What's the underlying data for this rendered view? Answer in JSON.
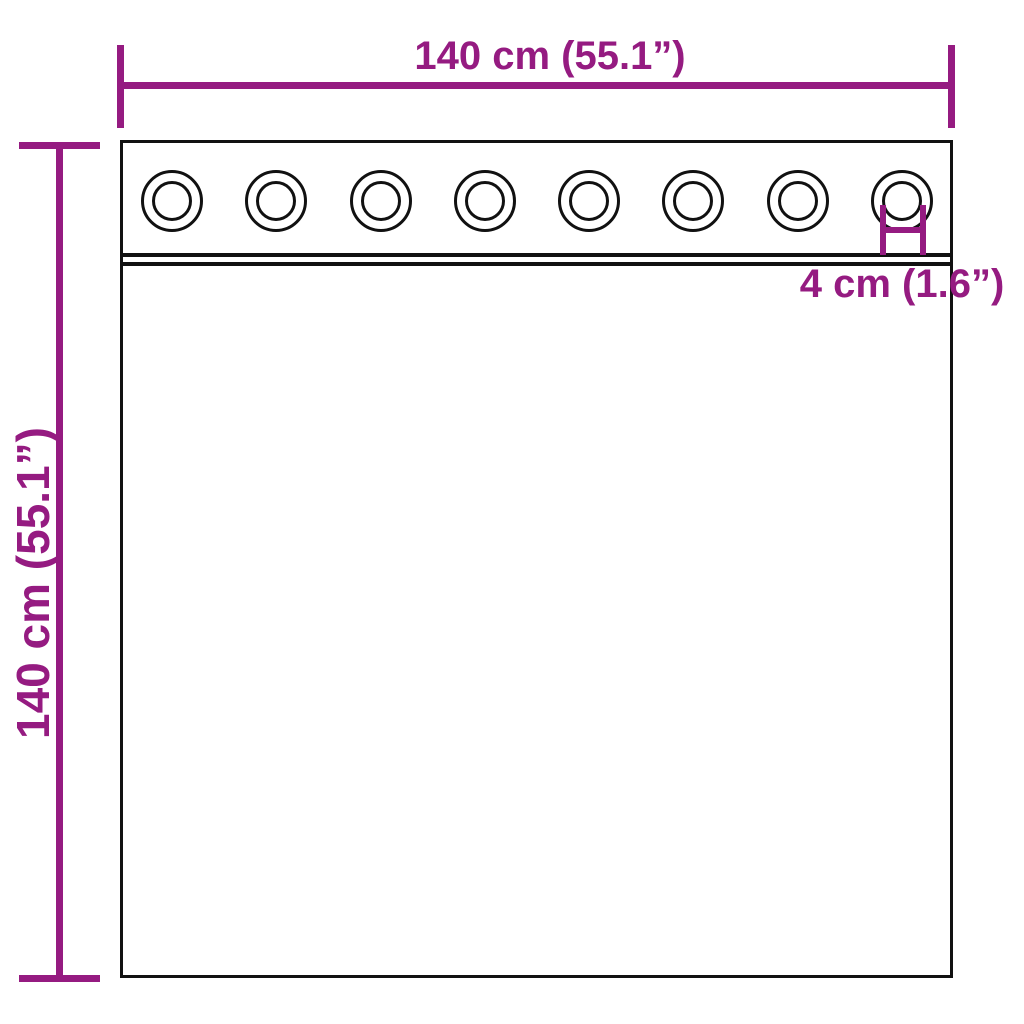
{
  "diagram": {
    "type": "product-dimension-diagram",
    "subject": "curtain-with-eyelets",
    "background_color": "#ffffff",
    "accent_color": "#951b81",
    "line_color": "#111111",
    "labels": {
      "width": "140 cm (55.1”)",
      "height": "140 cm (55.1”)",
      "eyelet_diameter": "4 cm (1.6”)"
    },
    "eyelets": {
      "count": 8,
      "first_center_x": 49,
      "spacing": 104.29,
      "outer_diameter_px": 62,
      "inner_diameter_px": 40
    }
  }
}
